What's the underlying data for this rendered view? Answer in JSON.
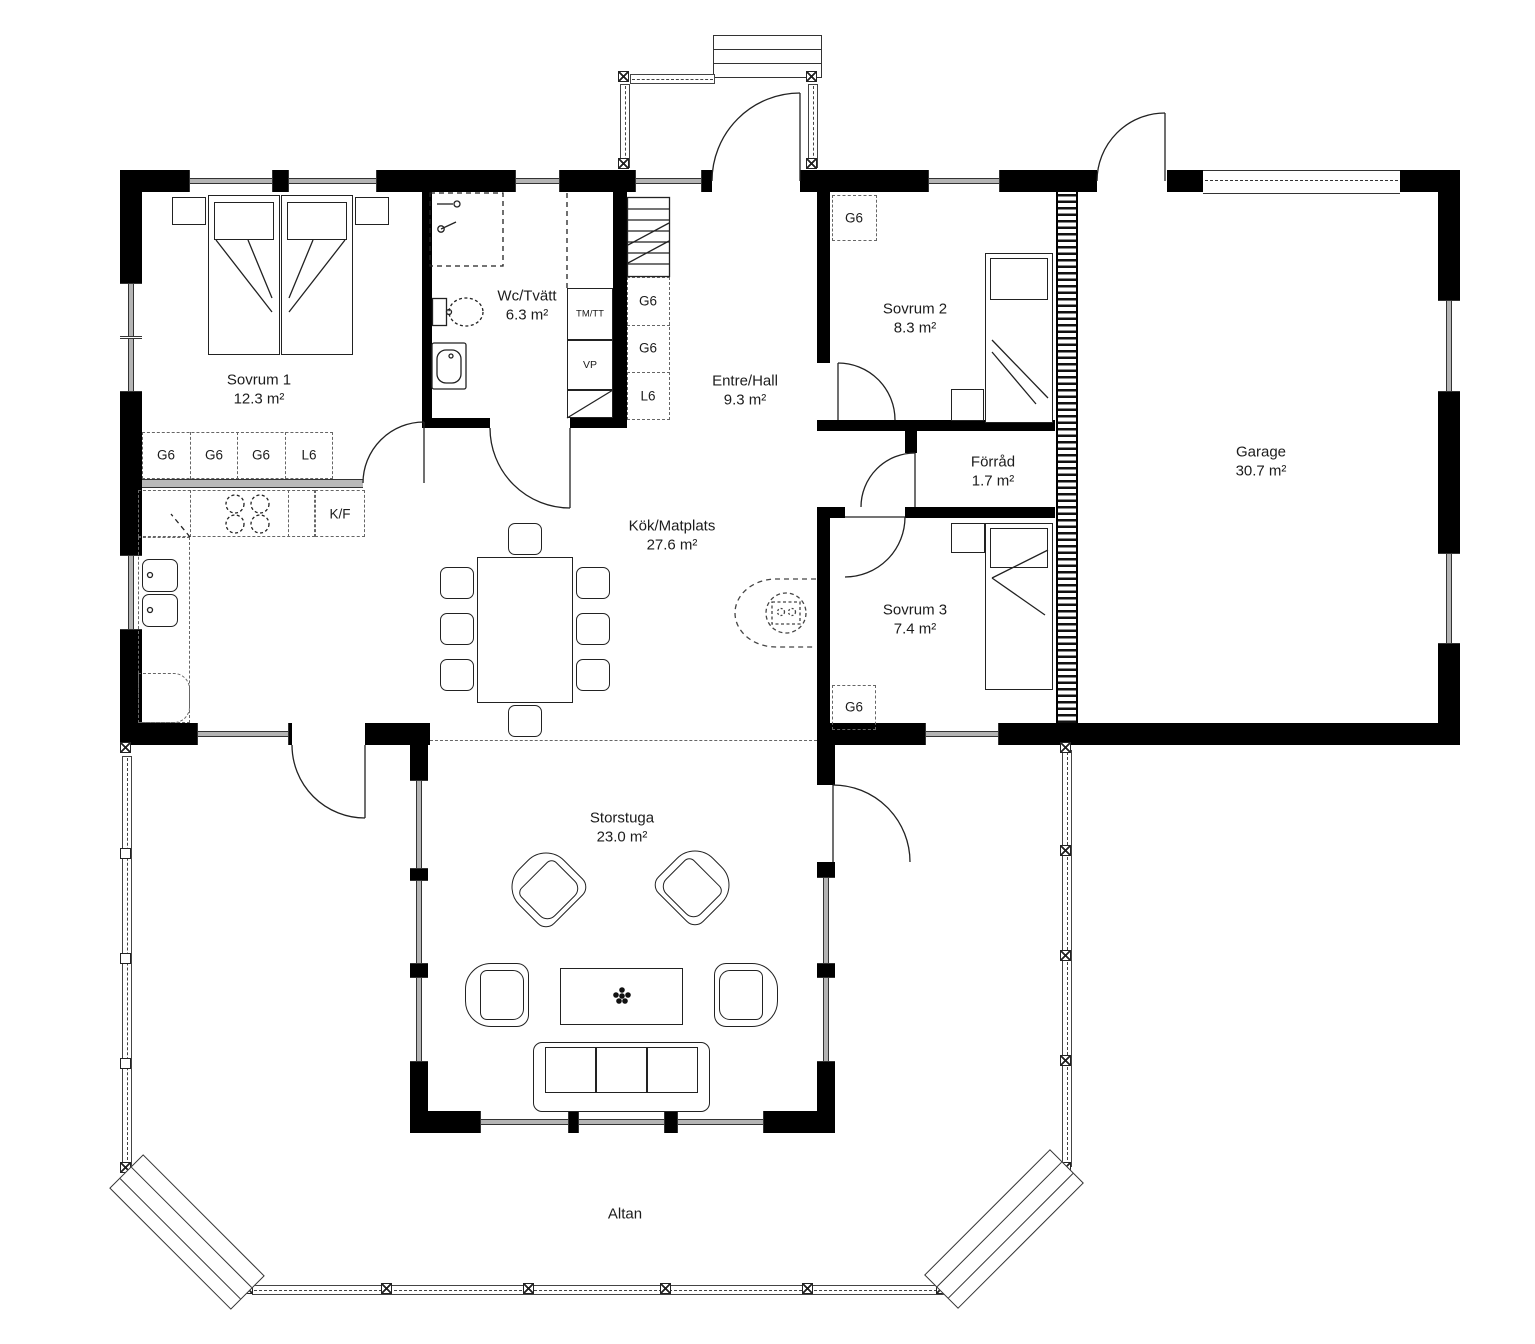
{
  "rooms": [
    {
      "name": "Sovrum 1",
      "area": "12.3 m²"
    },
    {
      "name": "Wc/Tvätt",
      "area": "6.3 m²"
    },
    {
      "name": "Entre/Hall",
      "area": "9.3 m²"
    },
    {
      "name": "Sovrum 2",
      "area": "8.3 m²"
    },
    {
      "name": "Förråd",
      "area": "1.7 m²"
    },
    {
      "name": "Sovrum 3",
      "area": "7.4 m²"
    },
    {
      "name": "Kök/Matplats",
      "area": "27.6 m²"
    },
    {
      "name": "Storstuga",
      "area": "23.0 m²"
    },
    {
      "name": "Garage",
      "area": "30.7 m²"
    },
    {
      "name": "Altan",
      "area": ""
    }
  ],
  "fixture_codes": {
    "wardrobe": "G6",
    "linen_closet": "L6",
    "fridge_freezer": "K/F",
    "washer_dryer": "TM/TT",
    "heat_pump": "VP"
  },
  "colors": {
    "wall": "#000000",
    "line": "#222222",
    "dashed": "#555555",
    "window_glass": "#b4b4b4"
  }
}
